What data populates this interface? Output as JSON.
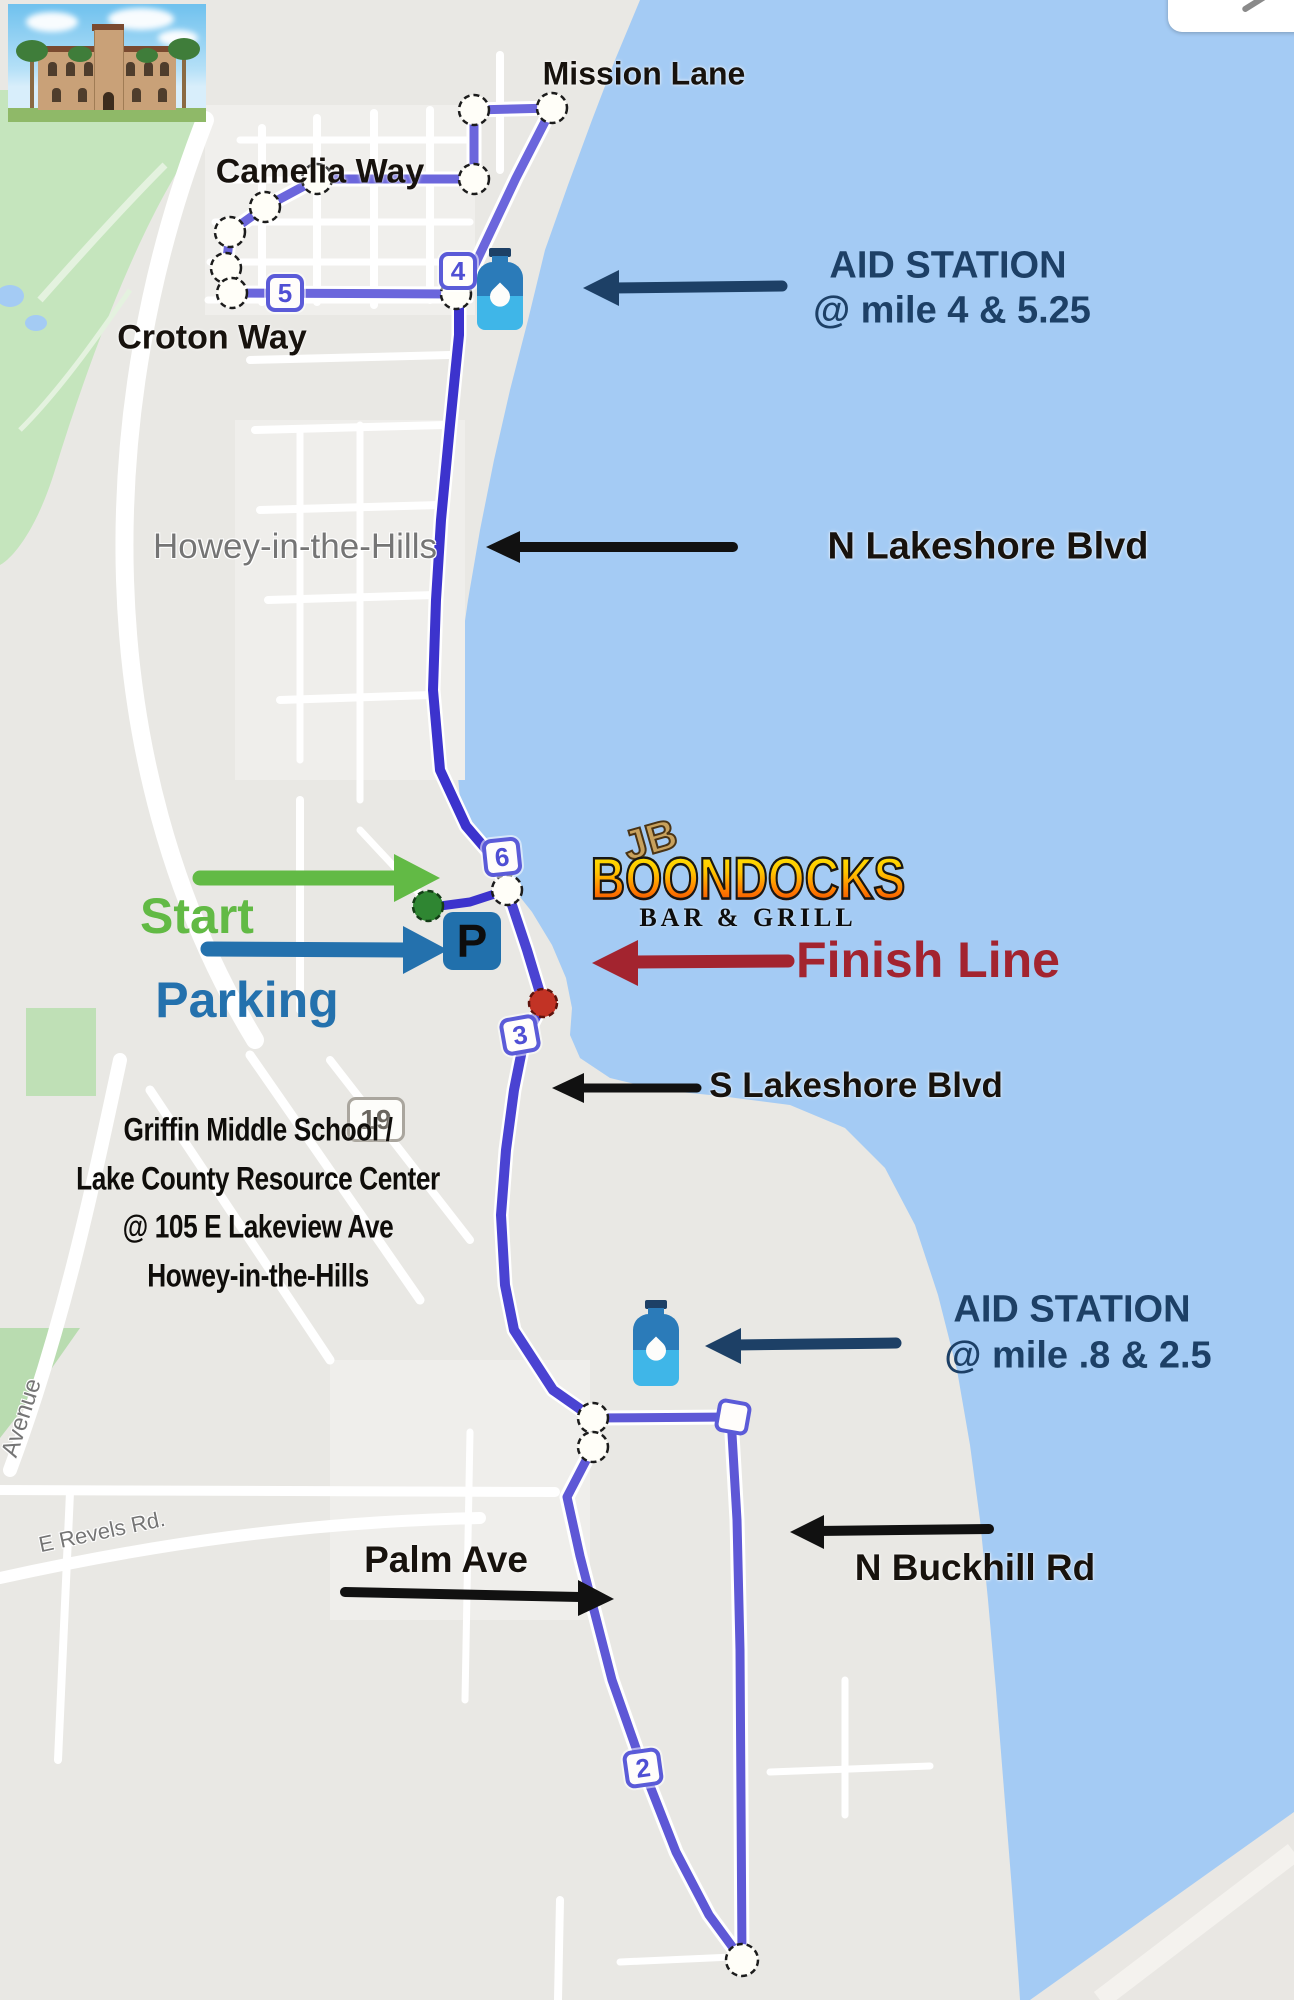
{
  "photo": {
    "alt": "historic-mansion-photo"
  },
  "map_labels": {
    "town": "Howey-in-the-Hills",
    "revels_rd": "E Revels Rd.",
    "avenue": "Avenue",
    "highway_shield": "19"
  },
  "streets": {
    "mission_lane": "Mission Lane",
    "camelia_way": "Camelia Way",
    "croton_way": "Croton Way",
    "n_lakeshore": "N Lakeshore Blvd",
    "s_lakeshore": "S Lakeshore Blvd",
    "palm_ave": "Palm Ave",
    "n_buckhill": "N Buckhill Rd"
  },
  "aid_station_1": {
    "title": "AID STATION",
    "miles": "@ mile 4 & 5.25"
  },
  "aid_station_2": {
    "title": "AID STATION",
    "miles": "@ mile .8 & 2.5"
  },
  "course": {
    "start_label": "Start",
    "parking_label": "Parking",
    "parking_symbol": "P",
    "finish_label": "Finish Line",
    "mile_markers": [
      "2",
      "3",
      "4",
      "5",
      "6"
    ]
  },
  "venue": {
    "line1": "Griffin Middle School /",
    "line2": "Lake County Resource Center",
    "line3": "@ 105 E Lakeview Ave",
    "line4": "Howey-in-the-Hills"
  },
  "boondocks": {
    "monogram": "JB",
    "name": "BOONDOCKS",
    "tagline": "BAR & GRILL"
  },
  "colors": {
    "water": "#a4cbf4",
    "land": "#e9e8e4",
    "route_purple": "#6b66dc",
    "route_indigo": "#3c33cd",
    "navy": "#1d4066",
    "start_green": "#62ba45",
    "parking_blue": "#2471ad",
    "finish_red": "#a3242f",
    "marker_red": "#c23325",
    "marker_green": "#2f8632"
  }
}
